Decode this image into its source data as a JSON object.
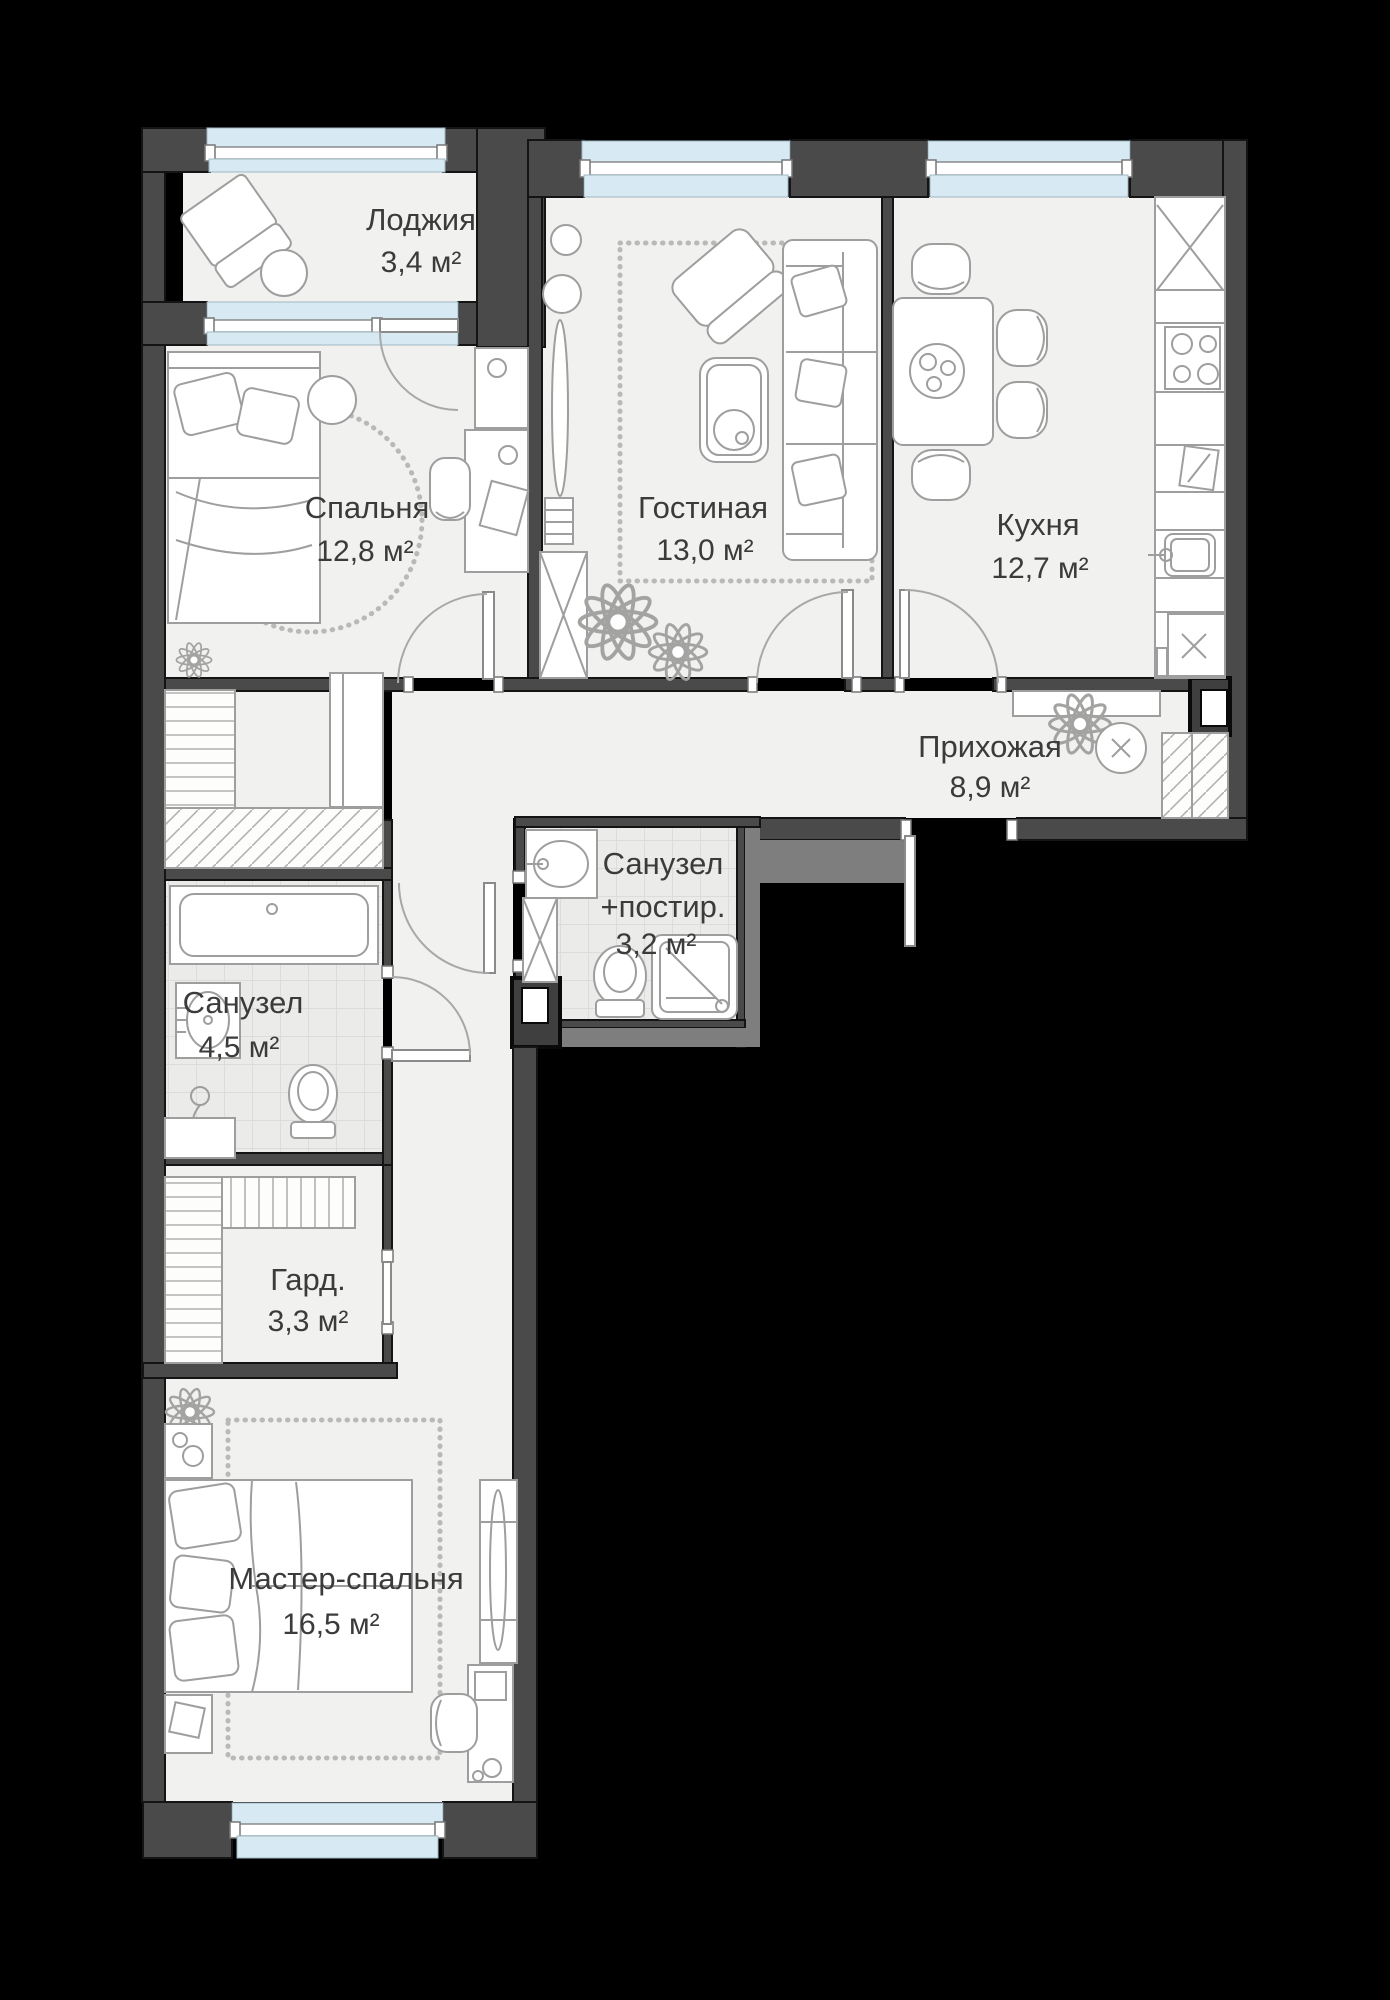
{
  "canvas": {
    "width": 1390,
    "height": 2000
  },
  "colors": {
    "background": "#000000",
    "wall": "#4a4a4a",
    "wall_light": "#7e7e7e",
    "wall_line": "#141414",
    "floor": "#f1f1ef",
    "tile_bg": "#ebebe9",
    "tile_line": "#dcdcda",
    "window_blue": "#d7eaf4",
    "window_frame": "#ffffff",
    "furn_stroke": "#9e9e9e",
    "label": "#3b3b3b",
    "carpet_dot": "#b9b9b7"
  },
  "rooms": [
    {
      "id": "loggia",
      "name": "Лоджия",
      "area": "3,4 м²"
    },
    {
      "id": "bedroom",
      "name": "Спальня",
      "area": "12,8 м²"
    },
    {
      "id": "living",
      "name": "Гостиная",
      "area": "13,0 м²"
    },
    {
      "id": "kitchen",
      "name": "Кухня",
      "area": "12,7 м²"
    },
    {
      "id": "hallway",
      "name": "Прихожая",
      "area": "8,9 м²"
    },
    {
      "id": "bathroom-laundry",
      "name": "Санузел",
      "name_line2": "+постир.",
      "area": "3,2 м²"
    },
    {
      "id": "bathroom",
      "name": "Санузел",
      "area": "4,5 м²"
    },
    {
      "id": "wardrobe",
      "name": "Гард.",
      "area": "3,3 м²"
    },
    {
      "id": "master-bedroom",
      "name": "Мастер-спальня",
      "area": "16,5 м²"
    }
  ],
  "furniture": [
    "lounge-chair",
    "round-table",
    "single-bed",
    "desk",
    "desk-chair",
    "dresser",
    "sofa",
    "armchair",
    "coffee-table",
    "carpet",
    "shelving-unit",
    "plants",
    "dining-table",
    "dining-chairs",
    "kitchen-counter",
    "stove",
    "kitchen-sink",
    "washing-machine",
    "console",
    "pouf",
    "built-in-wardrobe",
    "bathtub",
    "wash-basin",
    "toilet",
    "shower-cabin",
    "double-bed",
    "nightstand"
  ]
}
